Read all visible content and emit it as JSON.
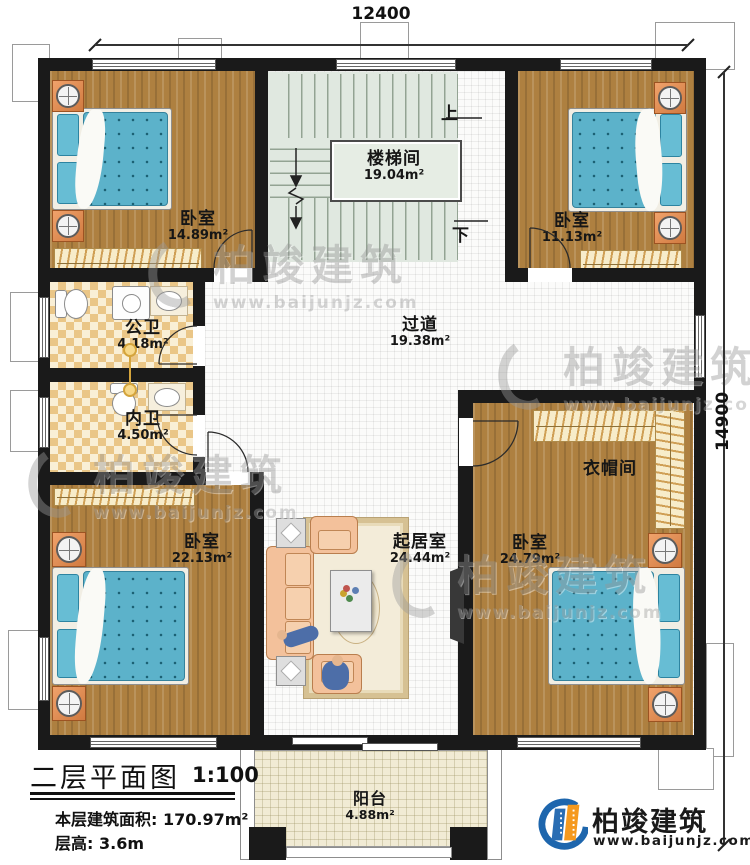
{
  "plan": {
    "title": "二层平面图",
    "scale": "1:100",
    "area_label": "本层建筑面积:",
    "area_value": "170.97m²",
    "height_label": "层高:",
    "height_value": "3.6m"
  },
  "dims": {
    "top": "12400",
    "right": "14900"
  },
  "rooms": [
    {
      "id": "bedroom-top-left",
      "name": "卧室",
      "area": "14.89m²"
    },
    {
      "id": "stairwell",
      "name": "楼梯间",
      "area": "19.04m²"
    },
    {
      "id": "bedroom-top-right",
      "name": "卧室",
      "area": "11.13m²"
    },
    {
      "id": "public-bathroom",
      "name": "公卫",
      "area": "4.18m²"
    },
    {
      "id": "private-bathroom",
      "name": "内卫",
      "area": "4.50m²"
    },
    {
      "id": "hallway",
      "name": "过道",
      "area": "19.38m²"
    },
    {
      "id": "cloakroom",
      "name": "衣帽间",
      "area": ""
    },
    {
      "id": "bedroom-bottom-left",
      "name": "卧室",
      "area": "22.13m²"
    },
    {
      "id": "living-room",
      "name": "起居室",
      "area": "24.44m²"
    },
    {
      "id": "bedroom-bottom-right",
      "name": "卧室",
      "area": "24.79m²"
    },
    {
      "id": "balcony",
      "name": "阳台",
      "area": "4.88m²"
    }
  ],
  "stairs": {
    "up": "上",
    "down": "下"
  },
  "wm": {
    "brand": "柏竣建筑",
    "url": "www.baijunjz.com"
  },
  "logo": {
    "brand": "柏竣建筑",
    "url": "www.baijunjz.com"
  },
  "colors": {
    "wall": "#1a1a1a",
    "wood_floor": "#ae8040",
    "mattress_blue": "#5cb2ca",
    "tile_tan": "#eac687",
    "logo_blue": "#1e66ad",
    "logo_orange": "#f5991e"
  }
}
